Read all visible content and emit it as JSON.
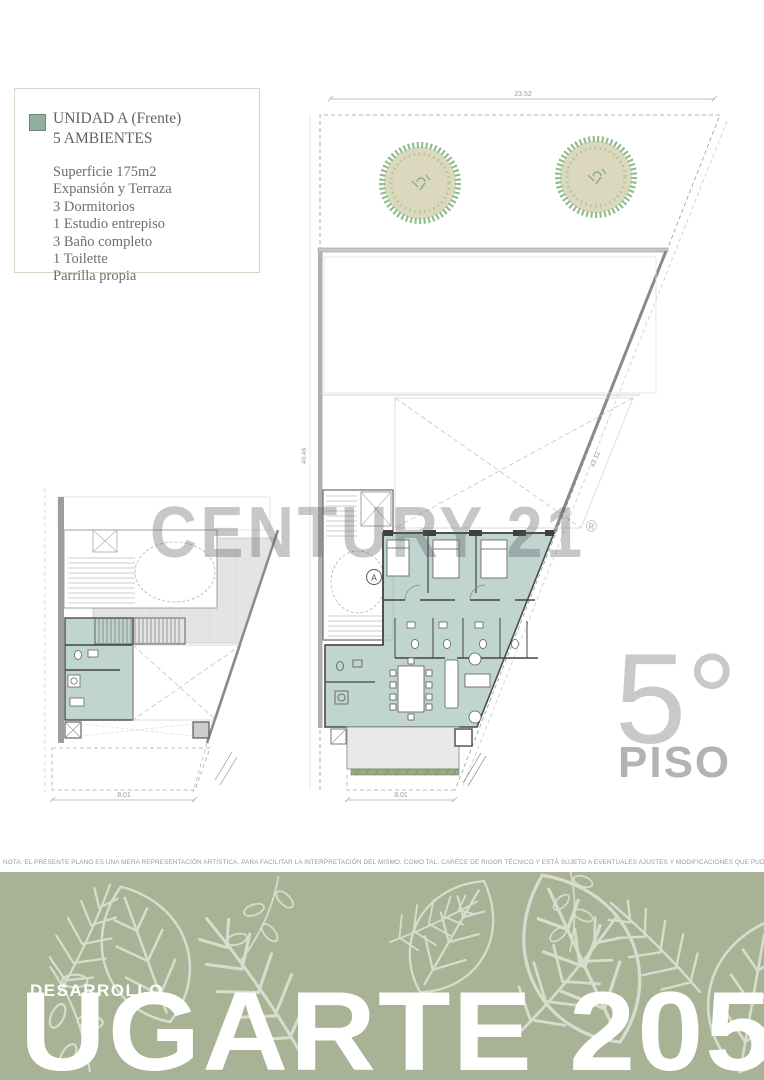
{
  "legend": {
    "title_line1": "UNIDAD A (Frente)",
    "title_line2": "5 AMBIENTES",
    "details": [
      "Superficie 175m2",
      "Expansión y Terraza",
      "3 Dormitorios",
      "1 Estudio entrepiso",
      "3 Baño completo",
      "1 Toilette",
      "Parrilla propia"
    ]
  },
  "watermark": {
    "brand": "CENTURY 21",
    "registered": "®"
  },
  "floor_badge": {
    "number": "5°",
    "label": "PISO"
  },
  "plans": {
    "main": {
      "dim_top": "23.52",
      "dim_left": "40.46",
      "dim_diag": "43.12",
      "dim_bottom": "8.01",
      "unit_marker": "A"
    },
    "mezzanine": {
      "dim_bottom": "8.01"
    }
  },
  "note": "NOTA: EL PRESENTE PLANO ES UNA MERA REPRESENTACIÓN ARTÍSTICA, PARA FACILITAR LA INTERPRETACIÓN DEL MISMO. COMO TAL, CARECE DE RIGOR TÉCNICO Y ESTÁ SUJETO A EVENTUALES AJUSTES Y MODIFICACIONES QUE PUDIERAN SURGIR DEL MISMO.",
  "banner": {
    "kicker": "DESARROLLO",
    "title": "UGARTE 2055"
  },
  "colors": {
    "unit_fill": "#b9d0ca",
    "legend_swatch": "#93ae9f",
    "banner_bg": "#a8b294",
    "tree_fill": "#dcd8bd",
    "tree_foliage": "#74b074",
    "watermark_gray": "#c8c8cb"
  }
}
